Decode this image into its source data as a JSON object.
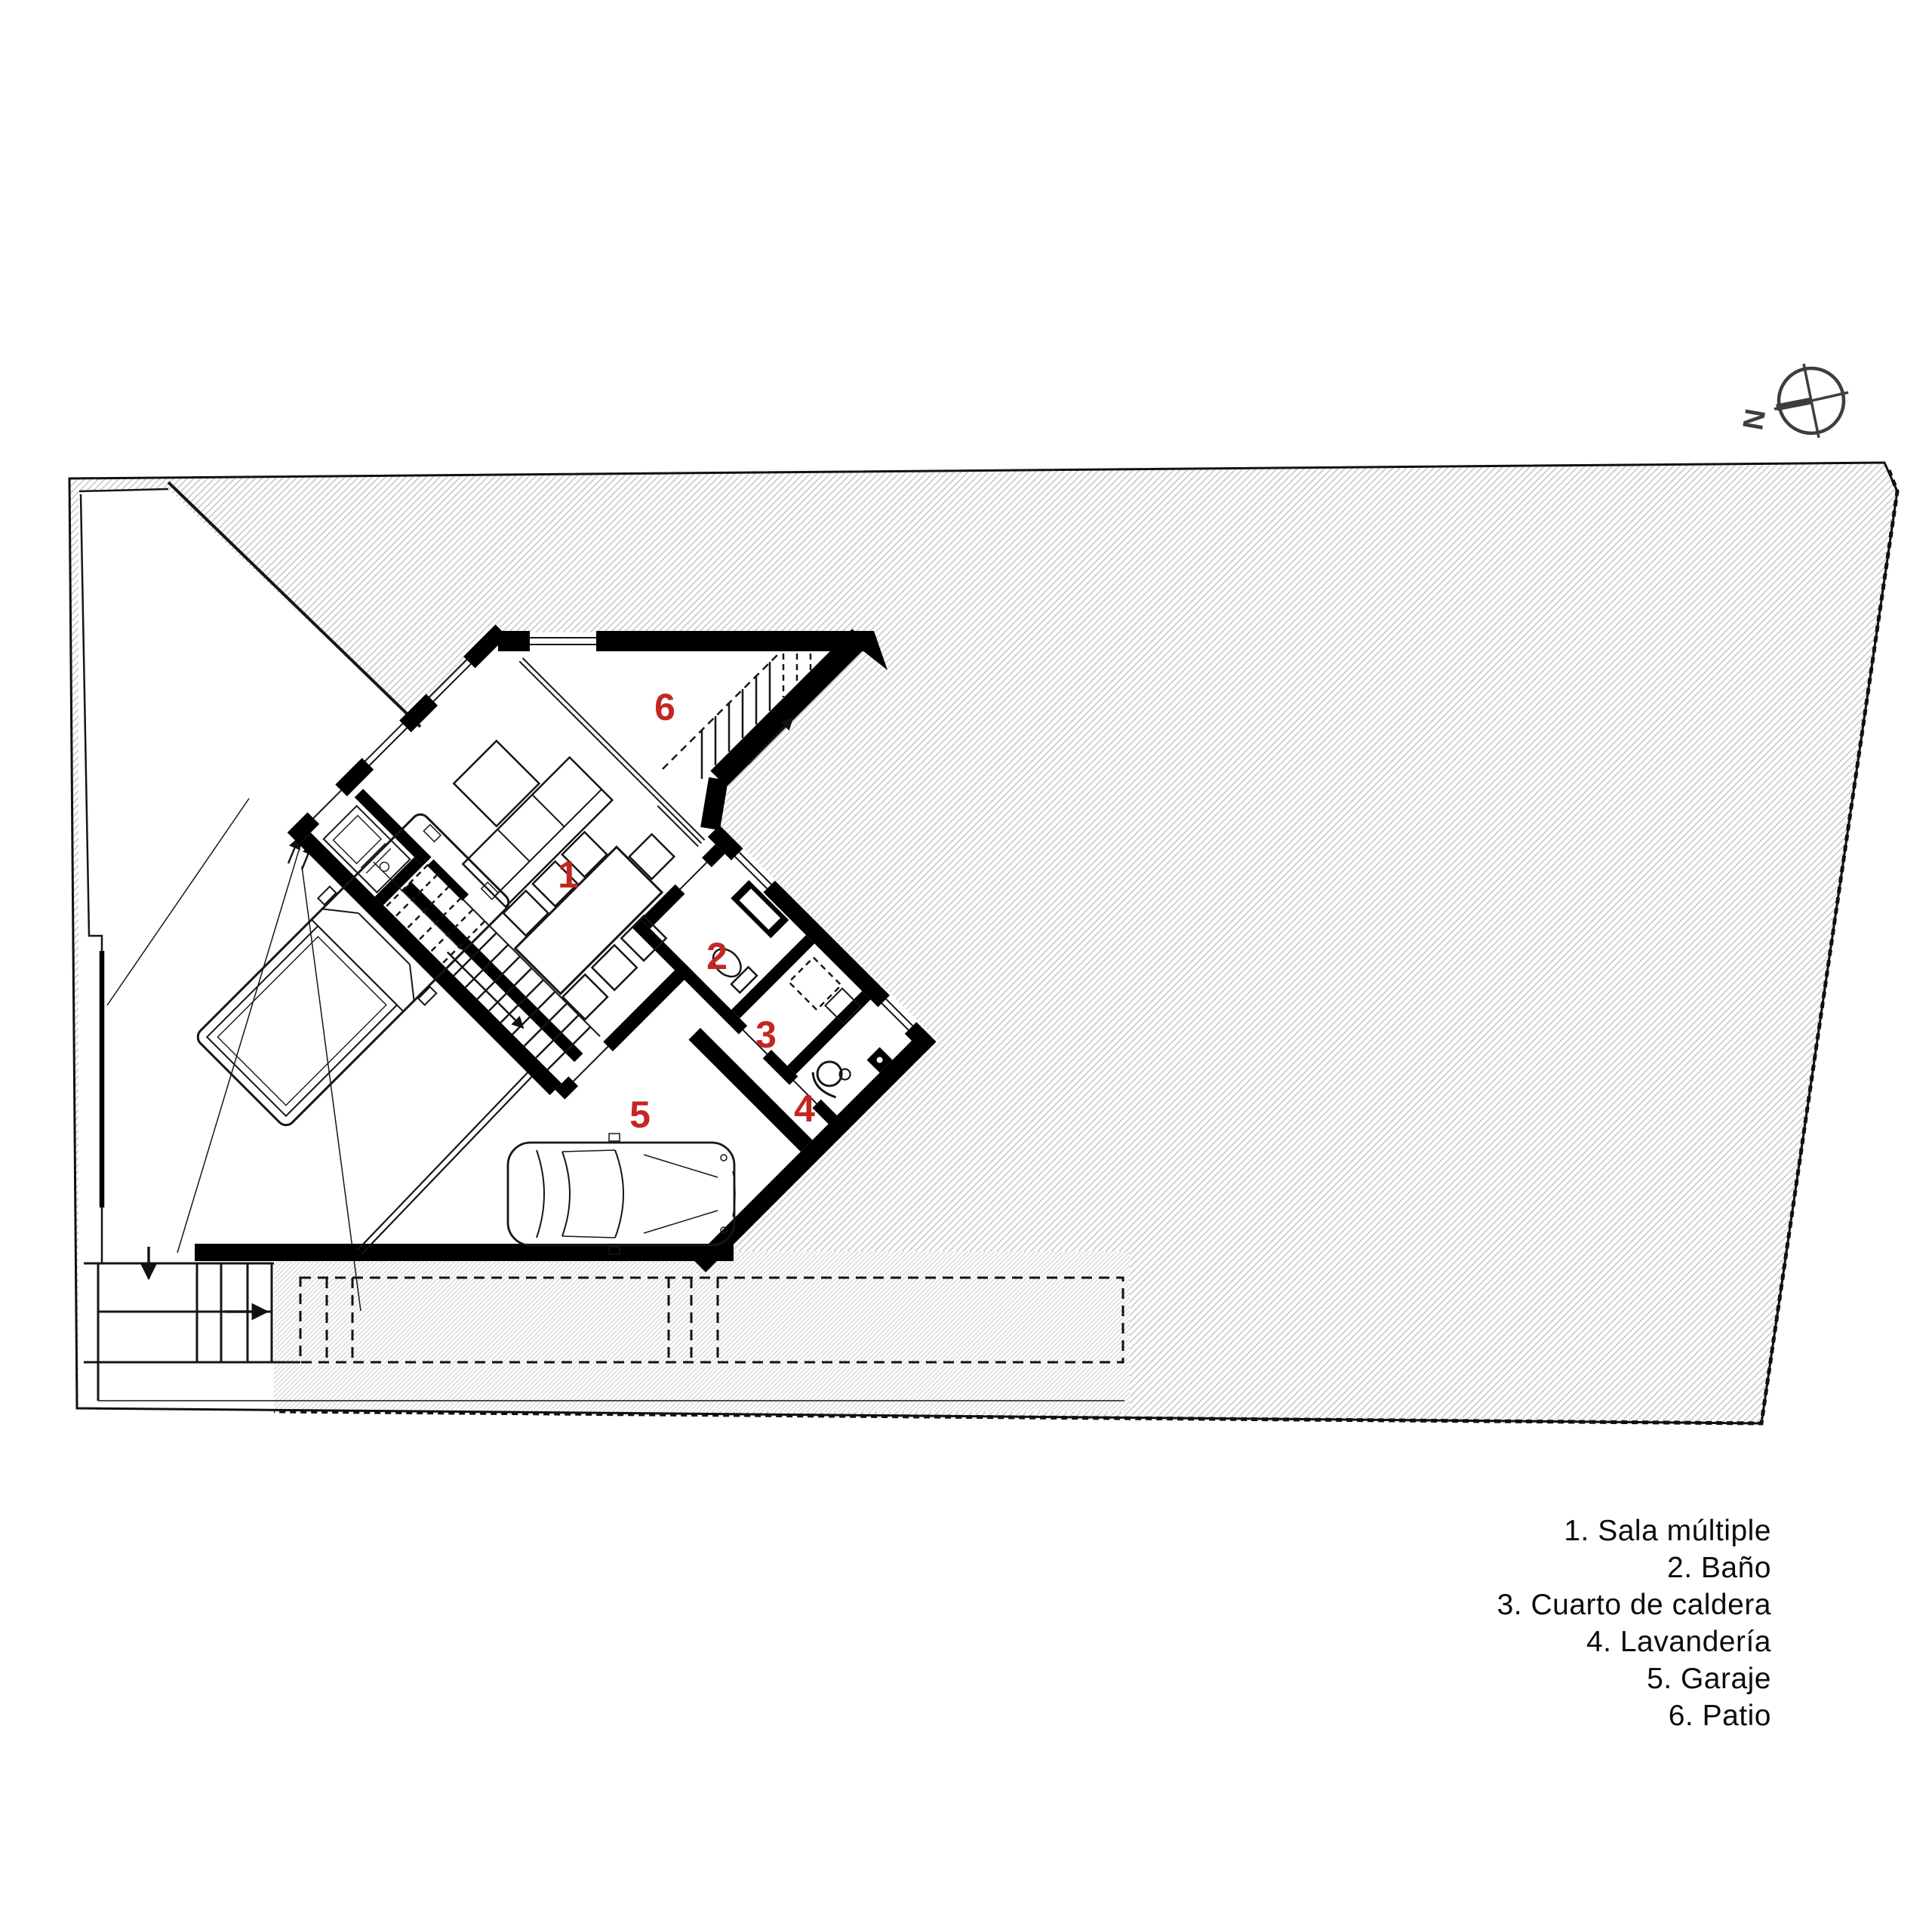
{
  "compass": {
    "letter": "N"
  },
  "rooms": [
    {
      "number": "1",
      "name": "Sala múltiple"
    },
    {
      "number": "2",
      "name": "Baño"
    },
    {
      "number": "3",
      "name": "Cuarto de caldera"
    },
    {
      "number": "4",
      "name": "Lavandería"
    },
    {
      "number": "5",
      "name": "Garaje"
    },
    {
      "number": "6",
      "name": "Patio"
    }
  ],
  "legend": {
    "items": [
      "1. Sala múltiple",
      "2. Baño",
      "3. Cuarto de caldera",
      "4. Lavandería",
      "5. Garaje",
      "6. Patio"
    ]
  },
  "colors": {
    "room_number": "#c32723",
    "text": "#0c0c0c",
    "walls": "#000000",
    "site_hatch": "#c7c7c7",
    "paving_hatch": "#d3d3d3",
    "compass": "#3e3e3e",
    "background": "#ffffff"
  }
}
